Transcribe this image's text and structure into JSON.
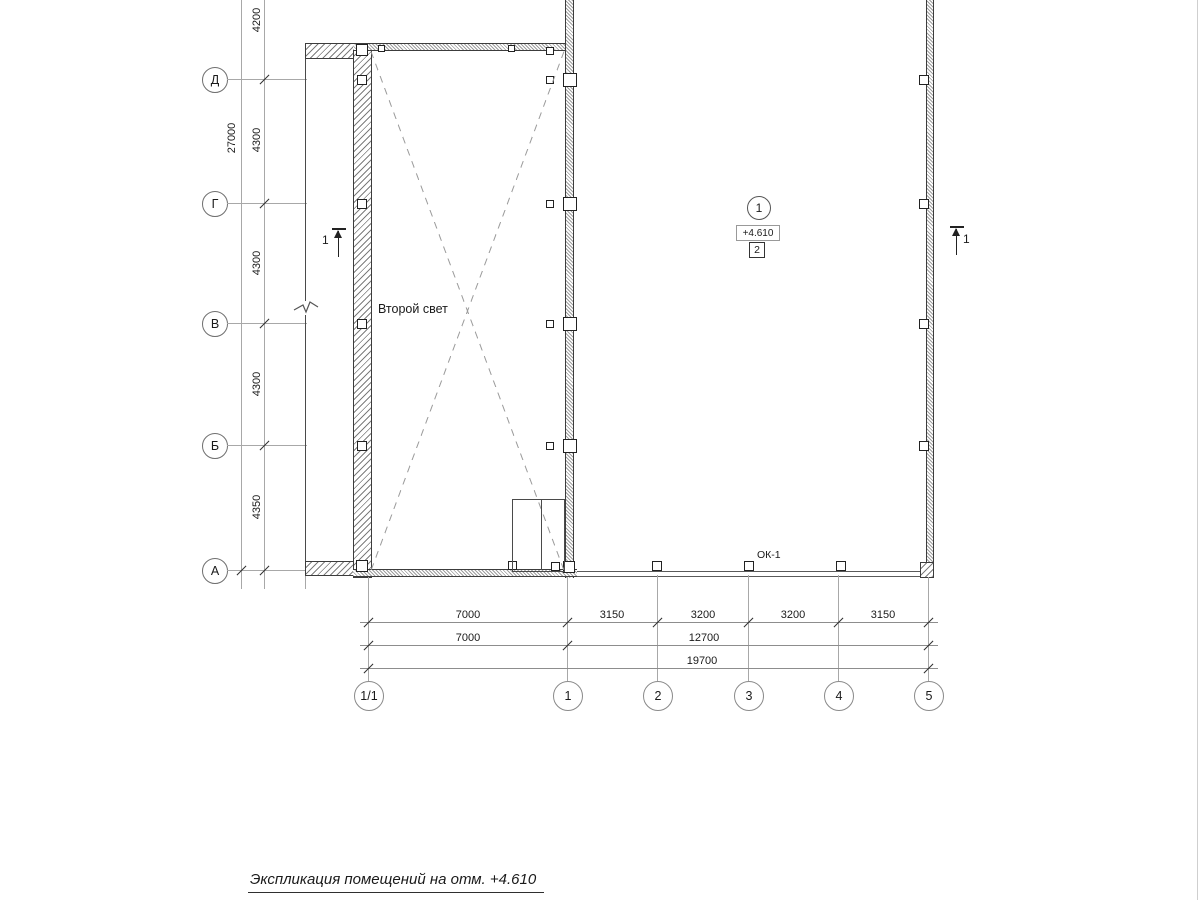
{
  "colors": {
    "background": "#ffffff",
    "ink": "#2f2f2f",
    "grid": "#a8a8a8"
  },
  "title": "Экспликация помещений на отм. +4.610",
  "plan": {
    "void_label": "Второй свет",
    "window_label": "ОК-1",
    "room_marker": {
      "axis_number": "1",
      "level": "+4.610",
      "room_number": "2"
    }
  },
  "section_marks": {
    "left_label": "1",
    "right_label": "1"
  },
  "left_axes": {
    "labels": [
      "Д",
      "Г",
      "В",
      "Б",
      "А"
    ]
  },
  "left_dims": {
    "total": "27000",
    "segments": [
      "4200",
      "4300",
      "4300",
      "4300",
      "4350"
    ]
  },
  "bottom_axes": {
    "labels": [
      "1/1",
      "1",
      "2",
      "3",
      "4",
      "5"
    ]
  },
  "bottom_dims": {
    "row1": [
      "7000",
      "3150",
      "3200",
      "3200",
      "3150"
    ],
    "row2": [
      "7000",
      "12700"
    ],
    "row3": [
      "19700"
    ]
  }
}
